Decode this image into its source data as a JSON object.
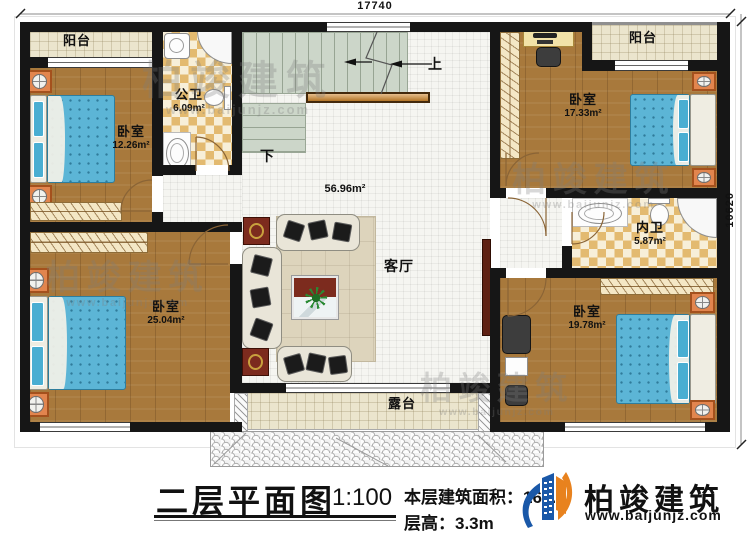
{
  "dimensions": {
    "top": "17740",
    "right": "10620"
  },
  "stairs": {
    "up_label": "上",
    "down_label": "下"
  },
  "rooms": {
    "balcony_left": {
      "name": "阳台"
    },
    "bath_public": {
      "name": "公卫",
      "area": "6.09m²"
    },
    "bedroom_a": {
      "name": "卧室",
      "area": "12.26m²"
    },
    "bedroom_b": {
      "name": "卧室",
      "area": "17.33m²"
    },
    "balcony_right": {
      "name": "阳台"
    },
    "bath_ensuite": {
      "name": "内卫",
      "area": "5.87m²"
    },
    "bedroom_c": {
      "name": "卧室",
      "area": "19.78m²"
    },
    "bedroom_d": {
      "name": "卧室",
      "area": "25.04m²"
    },
    "living": {
      "name": "客厅",
      "area": "56.96m²"
    },
    "terrace": {
      "name": "露台"
    }
  },
  "title_block": {
    "title": "二层平面图",
    "scale": "1:100",
    "floor_area_label": "本层建筑面积：",
    "floor_area_value": "166.6",
    "floor_height": "层高：3.3m"
  },
  "brand": {
    "name": "柏竣建筑",
    "website": "www.baijunjz.com"
  },
  "watermark": {
    "name": "柏竣建筑",
    "website": "www.baijunjz.com"
  },
  "colors": {
    "wall": "#161616",
    "wood": "#a8793c",
    "bed": "#5cb5d6",
    "checker": "#e3ba70",
    "tile": "#ebe5cd",
    "stair": "#ccd6c9",
    "maroon": "#7c2b1e",
    "rail": "#d2892e",
    "logo_blue": "#1a58a8",
    "logo_orange": "#e8821e"
  }
}
